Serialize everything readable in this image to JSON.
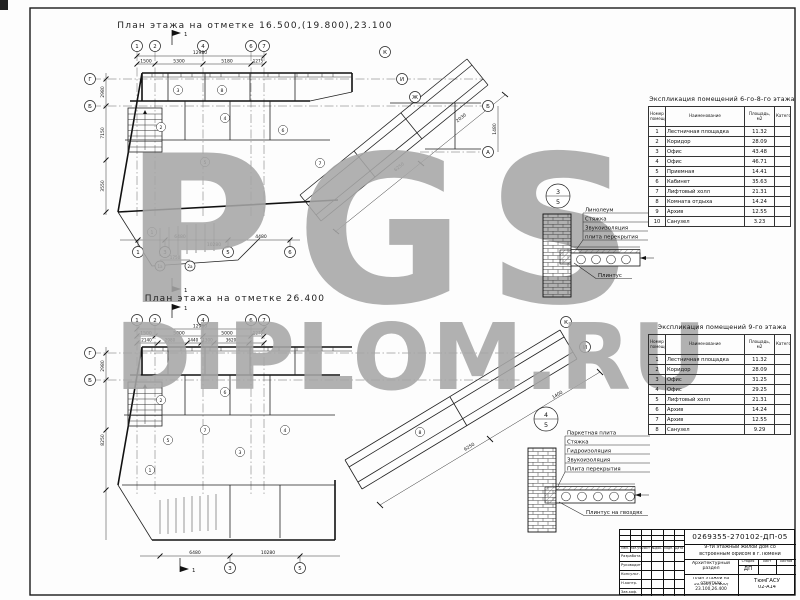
{
  "watermark": {
    "line1": "PGS",
    "line2": "DIPLOM.RU",
    "color": "#a7a7a7"
  },
  "plan_top": {
    "title": "План этажа на отметке 16.500,(19.800),23.100",
    "axes_top": [
      "1",
      "2",
      "4",
      "6",
      "7"
    ],
    "axes_left": [
      "Г",
      "Б"
    ],
    "axes_right": [
      "Б",
      "А"
    ],
    "axes_wing": [
      "К",
      "И",
      "Ж"
    ],
    "axes_bottom": [
      "1",
      "3",
      "5",
      "6"
    ],
    "axes_extra": [
      "1а",
      "2а"
    ],
    "section_flag": "1",
    "dim_total": "12980",
    "dims_top": [
      "1500",
      "5300",
      "5180",
      "1275"
    ],
    "dims_left": [
      "2980",
      "7150",
      "3550"
    ],
    "dims_bottom": [
      "6480",
      "10280",
      "4480"
    ],
    "dims_wing": [
      "6250",
      "2030"
    ],
    "dim_right": "1480",
    "dim_extra": "1750",
    "rooms": [
      "3",
      "8",
      "2",
      "4",
      "5",
      "6",
      "1",
      "7"
    ]
  },
  "plan_bottom": {
    "title": "План этажа на отметке 26.400",
    "axes_top": [
      "1",
      "2",
      "4",
      "6",
      "7"
    ],
    "axes_left": [
      "Г",
      "Б"
    ],
    "axes_wing": [
      "К",
      "И"
    ],
    "axes_bottom": [
      "3",
      "5"
    ],
    "section_flag": "1",
    "dim_total": "12980",
    "dims_top": [
      "1500",
      "5000",
      "5000",
      "1275"
    ],
    "dims_top2": [
      "2140",
      "2980",
      "1440",
      "1300",
      "3620"
    ],
    "dims_left": [
      "2980",
      "8250"
    ],
    "dims_bottom": [
      "6480",
      "10280"
    ],
    "dims_wing": [
      "6250",
      "1400"
    ],
    "rooms": [
      "2",
      "6",
      "7",
      "5",
      "3",
      "4",
      "1",
      "8"
    ]
  },
  "schedule_upper": {
    "title": "Экспликация помещений 6-го-8-го этажа",
    "columns": [
      "Номер помещения",
      "Наименование",
      "Площадь, м2",
      "Категория"
    ],
    "rows": [
      {
        "num": "1",
        "name": "Лестничная площадка",
        "area": "11.32"
      },
      {
        "num": "2",
        "name": "Коридор",
        "area": "28.09"
      },
      {
        "num": "3",
        "name": "Офис",
        "area": "43.48"
      },
      {
        "num": "4",
        "name": "Офис",
        "area": "46.71"
      },
      {
        "num": "5",
        "name": "Приемная",
        "area": "14.41"
      },
      {
        "num": "6",
        "name": "Кабинет",
        "area": "35.63"
      },
      {
        "num": "7",
        "name": "Лифтовый холл",
        "area": "21.31"
      },
      {
        "num": "8",
        "name": "Комната отдыха",
        "area": "14.24"
      },
      {
        "num": "9",
        "name": "Архив",
        "area": "12.55"
      },
      {
        "num": "10",
        "name": "Санузел",
        "area": "3.23"
      }
    ]
  },
  "schedule_ninth": {
    "title": "Экспликация помещений 9-го этажа",
    "columns": [
      "Номер помещения",
      "Наименование",
      "Площадь, м2",
      "Категория"
    ],
    "rows": [
      {
        "num": "1",
        "name": "Лестничная площадка",
        "area": "11.32"
      },
      {
        "num": "2",
        "name": "Коридор",
        "area": "28.09"
      },
      {
        "num": "3",
        "name": "Офис",
        "area": "31.25"
      },
      {
        "num": "4",
        "name": "Офис",
        "area": "29.25"
      },
      {
        "num": "5",
        "name": "Лифтовый холл",
        "area": "21.31"
      },
      {
        "num": "6",
        "name": "Архив",
        "area": "14.24"
      },
      {
        "num": "7",
        "name": "Архив",
        "area": "12.55"
      },
      {
        "num": "8",
        "name": "Санузел",
        "area": "9.29"
      }
    ]
  },
  "detail_floor": {
    "marker_num": "3",
    "marker_sheet": "5",
    "layers": [
      "Линолеум",
      "Стяжка",
      "Звукоизоляция",
      "плита перекрытия"
    ],
    "callout": "Плинтус"
  },
  "detail_parquet": {
    "marker_num": "4",
    "marker_sheet": "5",
    "layers": [
      "Паркетная плита",
      "Стяжка",
      "Гидроизоляция",
      "Звукоизоляция",
      "Плита перекрытия"
    ],
    "callout": "Плинтус на гвоздях"
  },
  "title_block": {
    "doc_number": "0269355-270102-ДП-05",
    "project_line1": "9-ти этажный жилой дом со",
    "project_line2": "встроенным офисом в г.Тюмени",
    "section": "Архитектурный раздел",
    "stage_label": "Стадия",
    "sheet_label": "Лист",
    "sheets_label": "Листов",
    "stage": "ДП",
    "sheet_title_line1": "План этажей на отметках",
    "sheet_title_line2": "16.500,(19.800) 23.100,26.400",
    "org": "ТюмГАСУ",
    "group": "02-А14",
    "sign_header": [
      "Изм.",
      "Кол.уч",
      "Лист",
      "№док.",
      "Подп.",
      "Дата"
    ],
    "sign_rows": [
      "Разработал",
      "Руководит.",
      "Консульт.",
      "Н.контр.",
      "Зав.каф."
    ]
  }
}
